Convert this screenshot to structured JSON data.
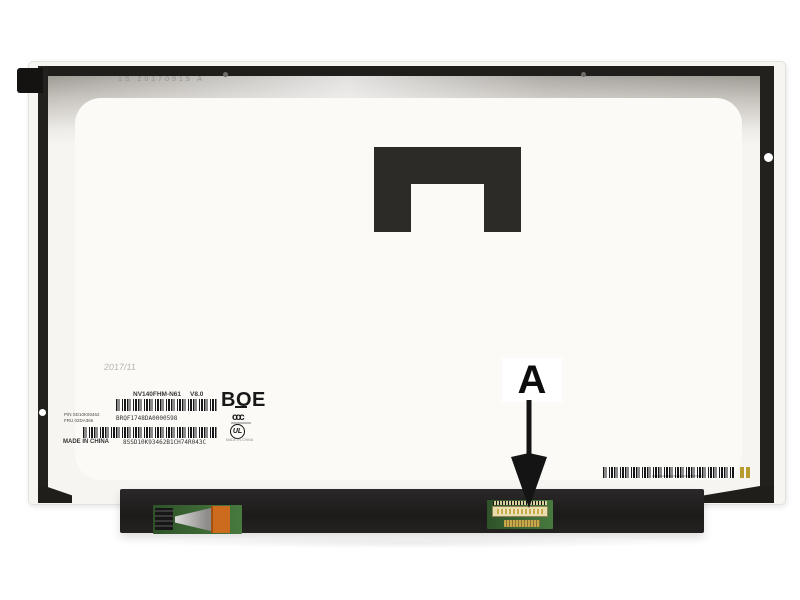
{
  "photo": {
    "date_stamp": "2017/11",
    "engraving": "1S 20170919 A"
  },
  "label": {
    "model": "NV140FHM-N61",
    "version": "V8.0",
    "brand": "BOE",
    "pn": "P/N SD10K93462",
    "fru": "FRU 02DA366",
    "serial": "BRQF1748DA0000598",
    "made_in": "MADE IN CHINA",
    "serial_full": "8SSD10K93462B1CH74R043C",
    "ccc_mark": "ccc",
    "ul_mark": "UL",
    "ul_made_in": "MADE IN CHINA"
  },
  "annotation": {
    "letter": "A"
  },
  "colors": {
    "frame_dark": "#201e1b",
    "bracket": "#2d2b28",
    "hinge_bar": "#232120",
    "pcb_green": "#3e6a38",
    "connector_cream": "#e8dcab",
    "orange_component": "#cc6a1d",
    "gold_marks": "#b89b2e"
  }
}
